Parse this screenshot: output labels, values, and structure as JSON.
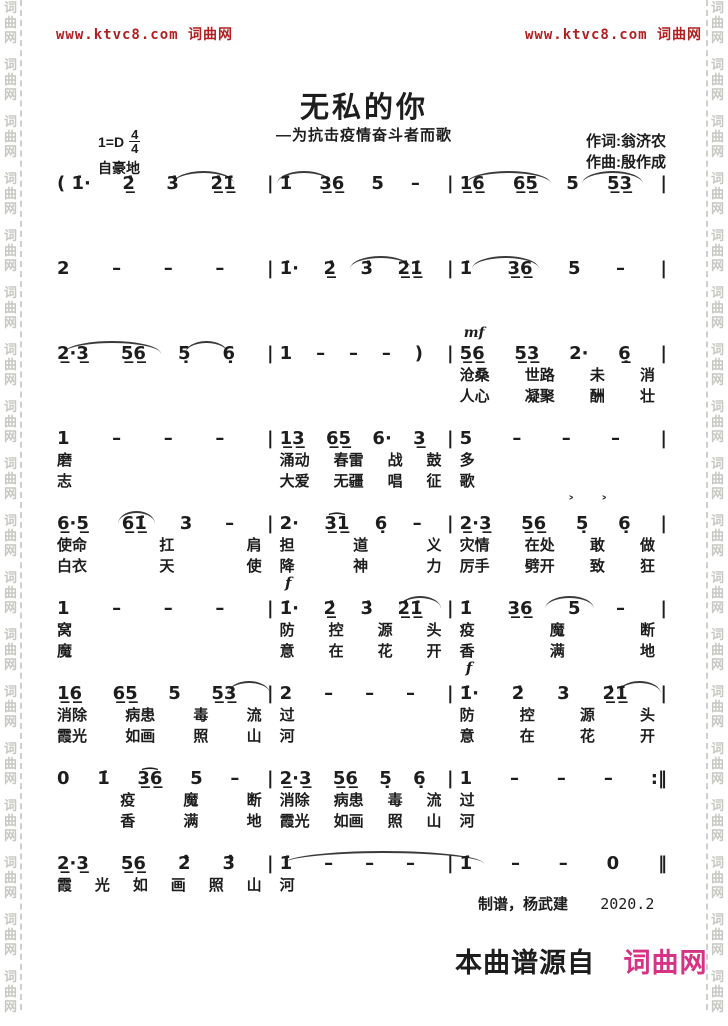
{
  "watermark": {
    "text": "词曲网"
  },
  "header": {
    "left": "www.ktvc8.com 词曲网",
    "right": "www.ktvc8.com 词曲网",
    "color": "#b02020"
  },
  "title": {
    "main": "无私的你",
    "subtitle": "—为抗击疫情奋斗者而歌"
  },
  "credits": {
    "lyricist": "作词:翁济农",
    "composer": "作曲:殷作成"
  },
  "keysig": {
    "key": "1=D",
    "beat_top": "4",
    "beat_bottom": "4",
    "expression": "自豪地"
  },
  "systems": [
    {
      "slurs": [
        [
          19,
          10
        ],
        [
          36,
          9
        ],
        [
          67,
          14
        ],
        [
          86,
          10
        ]
      ],
      "measures": [
        {
          "notes": [
            "( 1̇·",
            "2̲̇",
            "3̇",
            "2̲̇1̲̇",
            "|"
          ],
          "lyrics1": [],
          "lyrics2": []
        },
        {
          "notes": [
            "1̇",
            "3̲6̲",
            "5",
            "–",
            "|"
          ],
          "lyrics1": [],
          "lyrics2": []
        },
        {
          "notes": [
            "1̲6̲",
            "6̲5̲",
            "5",
            "5̲3̲",
            "|"
          ],
          "lyrics1": [],
          "lyrics2": []
        }
      ]
    },
    {
      "slurs": [
        [
          48,
          10
        ],
        [
          68,
          11
        ]
      ],
      "measures": [
        {
          "notes": [
            "2",
            "–",
            "–",
            "–",
            "|"
          ],
          "lyrics1": [],
          "lyrics2": []
        },
        {
          "notes": [
            "1̇·",
            "2̲̇",
            "3̇",
            "2̲̇1̲̇",
            "|"
          ],
          "lyrics1": [],
          "lyrics2": []
        },
        {
          "notes": [
            "1̇",
            "3̲6̲",
            "5",
            "–",
            "|"
          ],
          "lyrics1": [],
          "lyrics2": []
        }
      ]
    },
    {
      "slurs": [
        [
          1,
          16
        ],
        [
          21,
          7
        ]
      ],
      "measures": [
        {
          "notes": [
            "2̲·3̲",
            "5̲6̲",
            "5̣",
            "6̣",
            "|"
          ],
          "lyrics1": [],
          "lyrics2": []
        },
        {
          "notes": [
            "1",
            "–",
            "–",
            "–",
            ")",
            "|"
          ],
          "lyrics1": [],
          "lyrics2": []
        },
        {
          "notes": [
            "5̲6̲",
            "5̲3̲",
            "2·",
            "6̲̣",
            "|"
          ],
          "above": "mf",
          "lyrics1": [
            "沧桑",
            "世路",
            "未",
            "消"
          ],
          "lyrics2": [
            "人心",
            "凝聚",
            "酬",
            "壮"
          ]
        }
      ]
    },
    {
      "slurs": [],
      "measures": [
        {
          "notes": [
            "1",
            "–",
            "–",
            "–",
            "|"
          ],
          "lyrics1": [
            "磨"
          ],
          "lyrics2": [
            "志"
          ]
        },
        {
          "notes": [
            "1̲3̲",
            "6̲5̲",
            "6·",
            "3̲",
            "|"
          ],
          "lyrics1": [
            "涌动",
            "春雷",
            "战",
            "鼓"
          ],
          "lyrics2": [
            "大爱",
            "无疆",
            "唱",
            "征"
          ]
        },
        {
          "notes": [
            "5",
            "–",
            "–",
            "–",
            "|"
          ],
          "lyrics1": [
            "多"
          ],
          "lyrics2": [
            "歌"
          ]
        }
      ]
    },
    {
      "slurs": [
        [
          10,
          6
        ]
      ],
      "measures": [
        {
          "notes": [
            "6̲·5̲",
            "6̲1̲̇",
            "3",
            "–",
            "|"
          ],
          "lyrics1": [
            "使命",
            "扛",
            "肩"
          ],
          "lyrics2": [
            "白衣",
            "天",
            "使"
          ]
        },
        {
          "notes": [
            "2·",
            "3̲͡1̲",
            "6̣",
            "–",
            "|"
          ],
          "below": "f",
          "lyrics1": [
            "担",
            "道",
            "义"
          ],
          "lyrics2": [
            "降",
            "神",
            "力"
          ]
        },
        {
          "notes": [
            "2̲·3̲",
            "5̲6̲",
            "5̣",
            "6̣",
            "|"
          ],
          "above": "˃˃",
          "above_pos": "right",
          "lyrics1": [
            "灾情",
            "在处",
            "敢",
            "做"
          ],
          "lyrics2": [
            "厉手",
            "劈开",
            "致",
            "狂"
          ]
        }
      ]
    },
    {
      "slurs": [
        [
          56,
          7
        ],
        [
          80,
          8
        ]
      ],
      "measures": [
        {
          "notes": [
            "1",
            "–",
            "–",
            "–",
            "|"
          ],
          "lyrics1": [
            "窝"
          ],
          "lyrics2": [
            "魔"
          ]
        },
        {
          "notes": [
            "1̇·",
            "2̲̇",
            "3̇",
            "2̲̇1̲̇",
            "|"
          ],
          "lyrics1": [
            "防",
            "控",
            "源",
            "头"
          ],
          "lyrics2": [
            "意",
            "在",
            "花",
            "开"
          ]
        },
        {
          "notes": [
            "1̇",
            "3̲6̲",
            "5",
            "–",
            "|"
          ],
          "below": "f",
          "lyrics1": [
            "疫",
            "魔",
            "断"
          ],
          "lyrics2": [
            "香",
            "满",
            "地"
          ]
        }
      ]
    },
    {
      "slurs": [
        [
          28,
          7
        ],
        [
          92,
          7
        ]
      ],
      "measures": [
        {
          "notes": [
            "1̲6̲",
            "6̲5̲",
            "5",
            "5̲3̲",
            "|"
          ],
          "lyrics1": [
            "消除",
            "病患",
            "毒",
            "流"
          ],
          "lyrics2": [
            "霞光",
            "如画",
            "照",
            "山"
          ]
        },
        {
          "notes": [
            "2",
            "–",
            "–",
            "–",
            "|"
          ],
          "lyrics1": [
            "过"
          ],
          "lyrics2": [
            "河"
          ]
        },
        {
          "notes": [
            "1̇·",
            "2̇",
            "3",
            "2̲̇1̲̇",
            "|"
          ],
          "lyrics1": [
            "防",
            "控",
            "源",
            "头"
          ],
          "lyrics2": [
            "意",
            "在",
            "花",
            "开"
          ]
        }
      ]
    },
    {
      "slurs": [],
      "measures": [
        {
          "notes": [
            "0",
            "1̇",
            "3̲͡6̲",
            "5",
            "–",
            "|"
          ],
          "lyrics1": [
            "　",
            "疫",
            "魔",
            "断"
          ],
          "lyrics2": [
            "　",
            "香",
            "满",
            "地"
          ]
        },
        {
          "notes": [
            "2̲·3̲",
            "5̲6̲",
            "5̣",
            "6̣",
            "|"
          ],
          "lyrics1": [
            "消除",
            "病患",
            "毒",
            "流"
          ],
          "lyrics2": [
            "霞光",
            "如画",
            "照",
            "山"
          ]
        },
        {
          "notes": [
            "1",
            "–",
            "–",
            "–",
            ":‖"
          ],
          "lyrics1": [
            "过"
          ],
          "lyrics2": [
            "河"
          ]
        }
      ]
    },
    {
      "slurs": [
        [
          37,
          33
        ]
      ],
      "measures": [
        {
          "notes": [
            "2̲·3̲",
            "5̲6̲",
            "2̇̂",
            "3̇̂",
            "|"
          ],
          "lyrics1": [
            "霞",
            "光",
            "如",
            "画",
            "照",
            "山"
          ],
          "lyrics2": []
        },
        {
          "notes": [
            "1̇",
            "–",
            "–",
            "–",
            "|"
          ],
          "lyrics1": [
            "河"
          ],
          "lyrics2": []
        },
        {
          "notes": [
            "1̇",
            "–",
            "–",
            "0",
            "‖"
          ],
          "lyrics1": [],
          "lyrics2": []
        }
      ]
    }
  ],
  "footer": {
    "maker": "制谱，杨武建",
    "date": "2020.2"
  },
  "source": {
    "prefix": "本曲谱源自",
    "brand": "词曲网",
    "brand_color": "#d63384"
  }
}
